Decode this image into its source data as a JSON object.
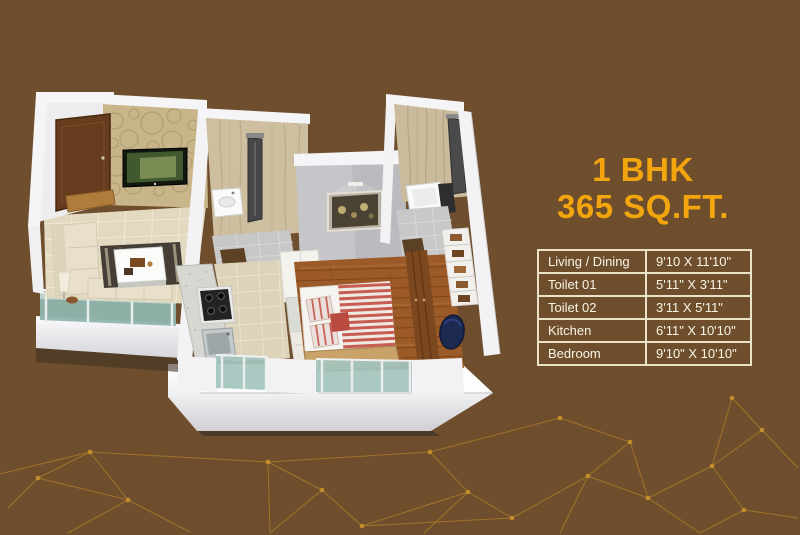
{
  "page": {
    "background_color": "#6e4e2d"
  },
  "title": {
    "line1": "1 BHK",
    "line2": "365 SQ.FT.",
    "color": "#F2A50C"
  },
  "dimensions_table": {
    "border_color": "#E9E3C8",
    "text_color": "#F8F5E6",
    "rows": [
      {
        "room": "Living / Dining",
        "size": "9'10 X 11'10\""
      },
      {
        "room": "Toilet 01",
        "size": "5'11\" X 3'11\""
      },
      {
        "room": "Toilet 02",
        "size": "3'11 X 5'11\""
      },
      {
        "room": "Kitchen",
        "size": "6'11\" X 10'10\""
      },
      {
        "room": "Bedroom",
        "size": "9'10\" X 10'10\""
      }
    ]
  },
  "floor_plan": {
    "description": "3D isometric cutaway render of a 1 BHK apartment",
    "features": [
      "entry-door",
      "living-dining-room",
      "tv-accent-wall",
      "sofa",
      "rug",
      "coffee-table",
      "floor-lamp",
      "balcony-glass-railing",
      "kitchen-counter",
      "gas-stove",
      "kitchen-sink",
      "kitchen-cabinets",
      "toilet-01-shower",
      "toilet-01-washbasin",
      "toilet-02-shower",
      "toilet-02-washbasin",
      "bedroom-wall-picture",
      "bed-with-striped-duvet",
      "pillows",
      "wardrobe",
      "towel-niche",
      "plinth-base"
    ]
  },
  "decor": {
    "network_line_color": "#BF8A28",
    "network_dot_color": "#D49A2E"
  }
}
